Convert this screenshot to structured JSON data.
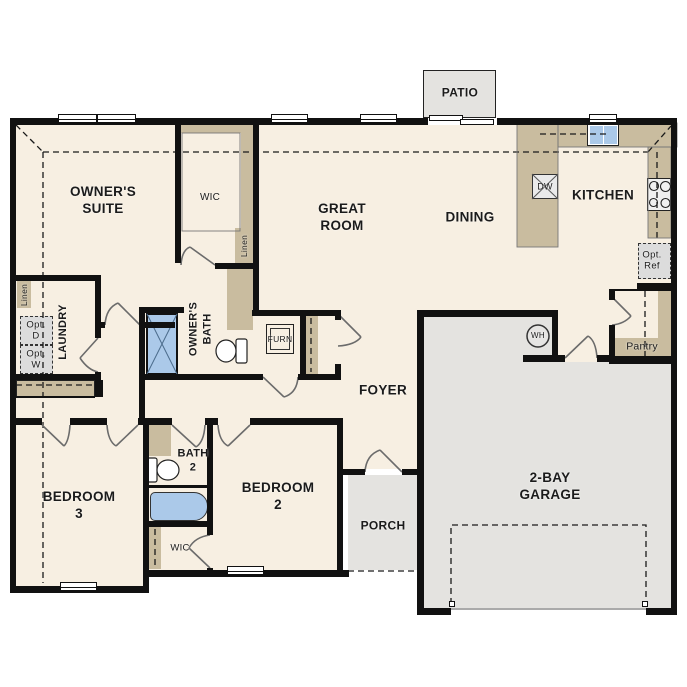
{
  "title": "single-story-floor-plan",
  "colors": {
    "floor": "#f7efe2",
    "casework": "#c9bc9f",
    "concrete": "#e4e3e0",
    "option_gray": "#dcdcdc",
    "fixture_blue": "#abc9e9",
    "wall": "#111111"
  },
  "rooms": {
    "owners_suite": "OWNER'S\nSUITE",
    "owners_wic": "WIC",
    "great_room": "GREAT\nROOM",
    "dining": "DINING",
    "kitchen": "KITCHEN",
    "patio": "PATIO",
    "laundry": "LAUNDRY",
    "owners_bath": "OWNER'S\nBATH",
    "foyer": "FOYER",
    "bedroom_3": "BEDROOM 3",
    "bath_2": "BATH\n2",
    "bedroom_2": "BEDROOM 2",
    "bedroom_2_wic": "WIC",
    "porch": "PORCH",
    "garage": "2-BAY\nGARAGE",
    "pantry": "Pantry"
  },
  "fixtures": {
    "dishwasher": "DW",
    "water_heater": "WH",
    "furnace": "FURN",
    "linen_hall": "Linen",
    "linen_laundry": "Linen",
    "opt_dryer": "Opt.\nD",
    "opt_washer": "Opt.\nW",
    "opt_fridge": "Opt.\nRef"
  }
}
